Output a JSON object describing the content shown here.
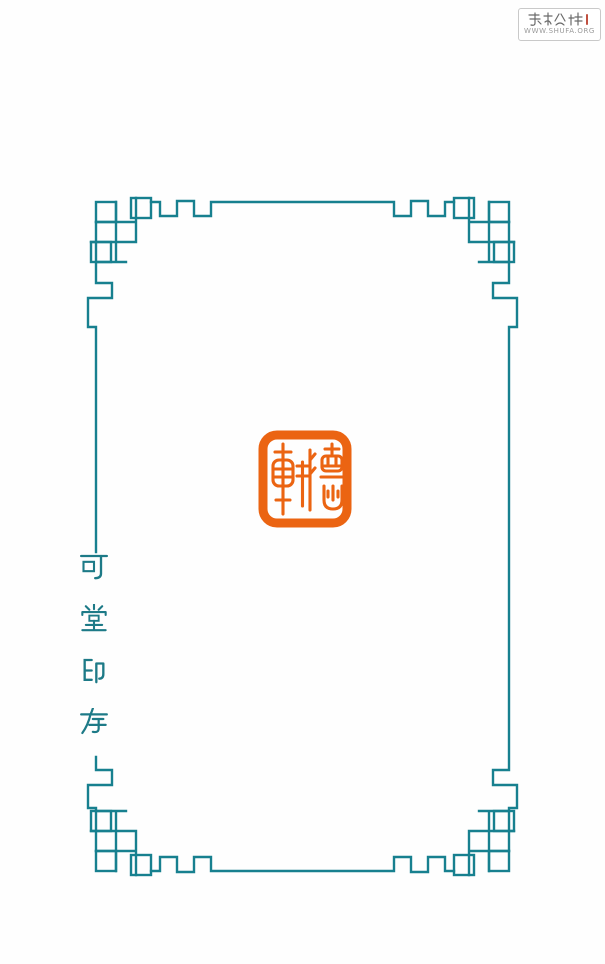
{
  "background": "#fefefe",
  "frame": {
    "color": "#17808f",
    "style": "chinese-fret-border-with-interlocking-square-corners"
  },
  "seal": {
    "text": "德軒",
    "script": "seal-script",
    "color": "#eb6412"
  },
  "side_text": {
    "value": "可堂印存",
    "chars": [
      "可",
      "堂",
      "印",
      "存"
    ],
    "orientation": "vertical",
    "color": "#1d7a87"
  },
  "watermark": {
    "site_name": "书艺公社",
    "url": "WWW.SHUFA.ORG"
  }
}
